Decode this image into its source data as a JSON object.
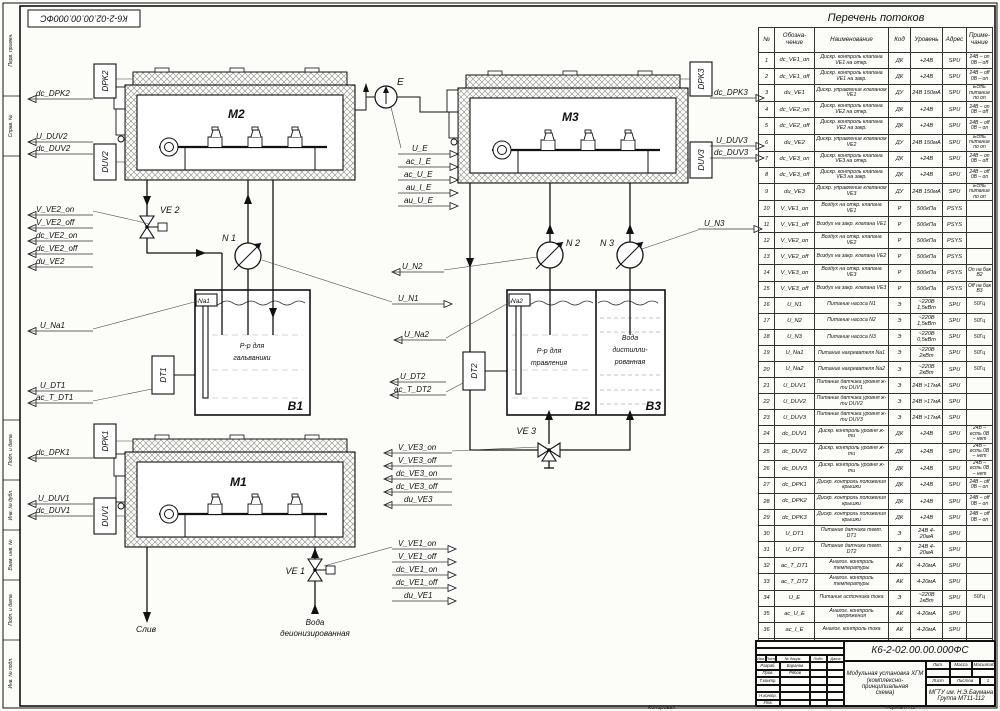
{
  "stamp_top_left": "К6-2-02.00.00.000ФС",
  "frame_strip": [
    "Перв. примен.",
    "Справ. №",
    "Подп. и дата",
    "Инв. № дубл.",
    "Взам. инв. №",
    "Подп. и дата",
    "Инв. № подл."
  ],
  "schematic": {
    "modules": {
      "m1": "M1",
      "m2": "M2",
      "m3": "M3"
    },
    "tanks": {
      "b1": "B1",
      "b1_l1": "Р-р для",
      "b1_l2": "гальваники",
      "b2": "B2",
      "b2_l1": "Р-р для",
      "b2_l2": "травления",
      "b3": "B3",
      "b3_l1": "Вода",
      "b3_l2": "дистилли-",
      "b3_l3": "рованная"
    },
    "pumps": {
      "n1": "N 1",
      "n2": "N 2",
      "n3": "N 3"
    },
    "valves": {
      "ve1": "VE 1",
      "ve2": "VE 2",
      "ve3": "VE 3"
    },
    "source_e": "E",
    "heaters": {
      "na1": "Na1",
      "na2": "Na2"
    },
    "temp_sensors": {
      "dt1": "DT1",
      "dt2": "DT2"
    },
    "boxes": {
      "dpk1": "DPK1",
      "dpk2": "DPK2",
      "dpk3": "DPK3",
      "duv1": "DUV1",
      "duv2": "DUV2",
      "duv3": "DUV3"
    },
    "flows": {
      "drain": "Слив",
      "di_water_1": "Вода",
      "di_water_2": "деионизированная"
    }
  },
  "signals": {
    "dc_DPK1": "dc_DPK1",
    "dc_DPK2": "dc_DPK2",
    "dc_DPK3": "dc_DPK3",
    "U_DUV1": "U_DUV1",
    "dc_DUV1": "dc_DUV1",
    "U_DUV2": "U_DUV2",
    "dc_DUV2": "dc_DUV2",
    "U_DUV3": "U_DUV3",
    "dc_DUV3": "dc_DUV3",
    "V_VE1_on": "V_VE1_on",
    "V_VE1_off": "V_VE1_off",
    "dc_VE1_on": "dc_VE1_on",
    "dc_VE1_off": "dc_VE1_off",
    "du_VE1": "du_VE1",
    "V_VE2_on": "V_VE2_on",
    "V_VE2_off": "V_VE2_off",
    "dc_VE2_on": "dc_VE2_on",
    "dc_VE2_off": "dc_VE2_off",
    "du_VE2": "du_VE2",
    "V_VE3_on": "V_VE3_on",
    "V_VE3_off": "V_VE3_off",
    "dc_VE3_on": "dc_VE3_on",
    "dc_VE3_off": "dc_VE3_off",
    "du_VE3": "du_VE3",
    "U_N1": "U_N1",
    "U_N2": "U_N2",
    "U_N3": "U_N3",
    "U_Na1": "U_Na1",
    "U_Na2": "U_Na2",
    "U_DT1": "U_DT1",
    "ac_T_DT1": "ac_T_DT1",
    "U_DT2": "U_DT2",
    "ac_T_DT2": "ac_T_DT2",
    "U_E": "U_E",
    "ac_I_E": "ac_I_E",
    "ac_U_E": "ac_U_E",
    "au_I_E": "au_I_E",
    "au_U_E": "au_U_E"
  },
  "flows_table": {
    "title": "Перечень потоков",
    "headers": {
      "num": "№",
      "sig": "Обозна- чение",
      "name": "Наименование",
      "code": "Код",
      "level": "Уровень",
      "addr": "Адрес",
      "note": "Приме- чание"
    },
    "rows": [
      {
        "n": "1",
        "sig": "dc_VE1_on",
        "name": "Дискр. контроль клапана VE1 на откр.",
        "code": "ДК",
        "level": "+24В",
        "addr": "SPU",
        "note": "24В – on 0В – off"
      },
      {
        "n": "2",
        "sig": "dc_VE1_off",
        "name": "Дискр. контроль клапана VE1 на закр.",
        "code": "ДК",
        "level": "+24В",
        "addr": "SPU",
        "note": "24В – off 0В – on"
      },
      {
        "n": "3",
        "sig": "du_VE1",
        "name": "Дискр. управление клапаном VE1",
        "code": "ДУ",
        "level": "24В 150мА",
        "addr": "SPU",
        "note": "Есть питание по on"
      },
      {
        "n": "4",
        "sig": "dc_VE2_on",
        "name": "Дискр. контроль клапана VE2 на откр.",
        "code": "ДК",
        "level": "+24В",
        "addr": "SPU",
        "note": "24В – on 0В – off"
      },
      {
        "n": "5",
        "sig": "dc_VE2_off",
        "name": "Дискр. контроль клапана VE2 на закр.",
        "code": "ДК",
        "level": "+24В",
        "addr": "SPU",
        "note": "24В – off 0В – on"
      },
      {
        "n": "6",
        "sig": "du_VE2",
        "name": "Дискр. управление клапаном VE2",
        "code": "ДУ",
        "level": "24В 150мА",
        "addr": "SPU",
        "note": "Есть питание по on"
      },
      {
        "n": "7",
        "sig": "dc_VE3_on",
        "name": "Дискр. контроль клапана VE3 на откр.",
        "code": "ДК",
        "level": "+24В",
        "addr": "SPU",
        "note": "24В – on 0В – off"
      },
      {
        "n": "8",
        "sig": "dc_VE3_off",
        "name": "Дискр. контроль клапана VE3 на закр.",
        "code": "ДК",
        "level": "+24В",
        "addr": "SPU",
        "note": "24В – off 0В – on"
      },
      {
        "n": "9",
        "sig": "du_VE3",
        "name": "Дискр. управление клапаном VE3",
        "code": "ДУ",
        "level": "24В 150мА",
        "addr": "SPU",
        "note": "Есть питание по on"
      },
      {
        "n": "10",
        "sig": "V_VE1_on",
        "name": "Воздух на откр. клапана VE1",
        "code": "P",
        "level": "500кПа",
        "addr": "PSYS",
        "note": ""
      },
      {
        "n": "11",
        "sig": "V_VE1_off",
        "name": "Воздух на закр. клапана VE1",
        "code": "P",
        "level": "500кПа",
        "addr": "PSYS",
        "note": ""
      },
      {
        "n": "12",
        "sig": "V_VE2_on",
        "name": "Воздух на откр. клапана VE2",
        "code": "P",
        "level": "500кПа",
        "addr": "PSYS",
        "note": ""
      },
      {
        "n": "13",
        "sig": "V_VE2_off",
        "name": "Воздух на закр. клапана VE2",
        "code": "P",
        "level": "500кПа",
        "addr": "PSYS",
        "note": ""
      },
      {
        "n": "14",
        "sig": "V_VE3_on",
        "name": "Воздух на откр. клапана VE3",
        "code": "P",
        "level": "500кПа",
        "addr": "PSYS",
        "note": "On на бак В2"
      },
      {
        "n": "15",
        "sig": "V_VE3_off",
        "name": "Воздух на закр. клапана VE3",
        "code": "P",
        "level": "500кПа",
        "addr": "PSYS",
        "note": "Off на бак В3"
      },
      {
        "n": "16",
        "sig": "U_N1",
        "name": "Питание насоса N1",
        "code": "Э",
        "level": "~220В 1,5кВт",
        "addr": "SPU",
        "note": "50Гц"
      },
      {
        "n": "17",
        "sig": "U_N2",
        "name": "Питание насоса N2",
        "code": "Э",
        "level": "~220В 1,5кВт",
        "addr": "SPU",
        "note": "50Гц"
      },
      {
        "n": "18",
        "sig": "U_N3",
        "name": "Питание насоса N3",
        "code": "Э",
        "level": "~220В 0,5кВт",
        "addr": "SPU",
        "note": "50Гц"
      },
      {
        "n": "19",
        "sig": "U_Na1",
        "name": "Питание нагревателя Na1",
        "code": "Э",
        "level": "~220В 2кВт",
        "addr": "SPU",
        "note": "50Гц"
      },
      {
        "n": "20",
        "sig": "U_Na2",
        "name": "Питание нагревателя Na2",
        "code": "Э",
        "level": "~220В 2кВт",
        "addr": "SPU",
        "note": "50Гц"
      },
      {
        "n": "21",
        "sig": "U_DUV1",
        "name": "Питание датчика уровня ж-ти DUV1",
        "code": "Э",
        "level": "24В >17мА",
        "addr": "SPU",
        "note": ""
      },
      {
        "n": "22",
        "sig": "U_DUV2",
        "name": "Питание датчика уровня ж-ти DUV2",
        "code": "Э",
        "level": "24В >17мА",
        "addr": "SPU",
        "note": ""
      },
      {
        "n": "23",
        "sig": "U_DUV3",
        "name": "Питание датчика уровня ж-ти DUV3",
        "code": "Э",
        "level": "24В >17мА",
        "addr": "SPU",
        "note": ""
      },
      {
        "n": "24",
        "sig": "dc_DUV1",
        "name": "Дискр. контроль уровня ж-ти",
        "code": "ДК",
        "level": "+24В",
        "addr": "SPU",
        "note": "24В – есть 0В – нет"
      },
      {
        "n": "25",
        "sig": "dc_DUV2",
        "name": "Дискр. контроль уровня ж-ти",
        "code": "ДК",
        "level": "+24В",
        "addr": "SPU",
        "note": "24В – есть 0В – нет"
      },
      {
        "n": "26",
        "sig": "dc_DUV3",
        "name": "Дискр. контроль уровня ж-ти",
        "code": "ДК",
        "level": "+24В",
        "addr": "SPU",
        "note": "24В – есть 0В – нет"
      },
      {
        "n": "27",
        "sig": "dc_DPK1",
        "name": "Дискр. контроль положения крышки",
        "code": "ДК",
        "level": "+24В",
        "addr": "SPU",
        "note": "24В – off 0В – on"
      },
      {
        "n": "28",
        "sig": "dc_DPK2",
        "name": "Дискр. контроль положения крышки",
        "code": "ДК",
        "level": "+24В",
        "addr": "SPU",
        "note": "24В – off 0В – on"
      },
      {
        "n": "29",
        "sig": "dc_DPK3",
        "name": "Дискр. контроль положения крышки",
        "code": "ДК",
        "level": "+24В",
        "addr": "SPU",
        "note": "24В – off 0В – on"
      },
      {
        "n": "30",
        "sig": "U_DT1",
        "name": "Питание датчика темп. DT1",
        "code": "Э",
        "level": "24В 4-20мА",
        "addr": "SPU",
        "note": ""
      },
      {
        "n": "31",
        "sig": "U_DT2",
        "name": "Питание датчика темп. DT2",
        "code": "Э",
        "level": "24В 4-20мА",
        "addr": "SPU",
        "note": ""
      },
      {
        "n": "32",
        "sig": "ac_T_DT1",
        "name": "Аналог. контроль температуры",
        "code": "АК",
        "level": "4-20мА",
        "addr": "SPU",
        "note": ""
      },
      {
        "n": "33",
        "sig": "ac_T_DT2",
        "name": "Аналог. контроль температуры",
        "code": "АК",
        "level": "4-20мА",
        "addr": "SPU",
        "note": ""
      },
      {
        "n": "34",
        "sig": "U_E",
        "name": "Питание источника тока",
        "code": "Э",
        "level": "~220В 1кВт",
        "addr": "SPU",
        "note": "50Гц"
      },
      {
        "n": "35",
        "sig": "ac_U_E",
        "name": "Аналог. контроль напряжения",
        "code": "АК",
        "level": "4-20мА",
        "addr": "SPU",
        "note": ""
      },
      {
        "n": "36",
        "sig": "ac_I_E",
        "name": "Аналог. контроль тока",
        "code": "АК",
        "level": "4-20мА",
        "addr": "SPU",
        "note": ""
      },
      {
        "n": "37",
        "sig": "au_U_E",
        "name": "Аналог. управление напряжением",
        "code": "АУ",
        "level": "4-20мА",
        "addr": "SPU",
        "note": ""
      },
      {
        "n": "38",
        "sig": "au_I_E",
        "name": "Аналог. управление током",
        "code": "АУ",
        "level": "4-20мА",
        "addr": "SPU",
        "note": ""
      }
    ]
  },
  "title_block": {
    "doc_number": "К6-2-02.00.00.000ФС",
    "title_l1": "Модульная установка ХГМ",
    "title_l2": "(комплексно-принципиальная",
    "title_l3": "схема)",
    "org_l1": "МГТУ им. Н.Э.Баумана",
    "org_l2": "Группа МТ11-112",
    "lit": "Лит.",
    "mass": "Масса",
    "scale": "Масштаб",
    "sheet_label": "Лист",
    "sheets_label": "Листов",
    "sheets_value": "1",
    "hdr": {
      "izm": "Изм.",
      "list": "Лист",
      "doc": "№ докум.",
      "podp": "Подп.",
      "data": "Дата"
    },
    "roles": {
      "r1": "Разраб.",
      "n1": "Баранов",
      "r2": "Пров.",
      "n2": "Рябов",
      "r3": "Т.контр.",
      "n3": "",
      "r4": "Н.контр.",
      "n4": "",
      "r5": "Утв.",
      "n5": ""
    },
    "footer_left": "Копировал",
    "footer_right": "Формат А3"
  }
}
